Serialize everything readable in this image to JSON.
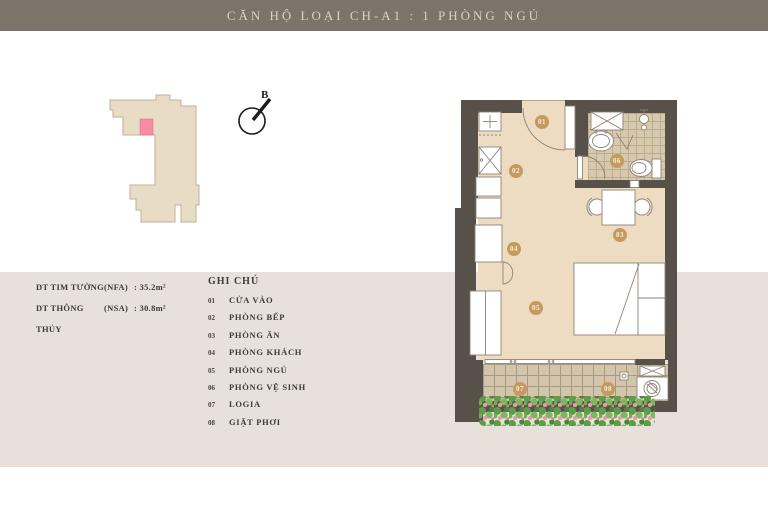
{
  "header": {
    "title": "CĂN HỘ LOẠI CH-A1 : 1 PHÒNG NGỦ"
  },
  "compass": {
    "label": "B"
  },
  "areas": {
    "rows": [
      {
        "label": "DT TIM TƯỜNG",
        "code": "(NFA)",
        "value": ": 35.2m²"
      },
      {
        "label": "DT THÔNG THỦY",
        "code": "(NSA)",
        "value": ": 30.8m²"
      }
    ]
  },
  "legend": {
    "heading": "GHI CHÚ",
    "items": [
      {
        "num": "01",
        "label": "CỬA VÀO"
      },
      {
        "num": "02",
        "label": "PHÒNG BẾP"
      },
      {
        "num": "03",
        "label": "PHÒNG ĂN"
      },
      {
        "num": "04",
        "label": "PHÒNG KHÁCH"
      },
      {
        "num": "05",
        "label": "PHÒNG NGỦ"
      },
      {
        "num": "06",
        "label": "PHÒNG VỆ SINH"
      },
      {
        "num": "07",
        "label": "LOGIA"
      },
      {
        "num": "08",
        "label": "GIẶT PHƠI"
      }
    ]
  },
  "colors": {
    "header-bg": "#7c7369",
    "header-text": "#d9d2c6",
    "band": "#e8e1db",
    "wall": "#57514a",
    "floor": "#eddcc2",
    "tile": "#d7c9ae",
    "loggia-tile": "#d3c5ac",
    "marker": "#c59a5f",
    "text": "#3e3a35",
    "keyplan-fill": "#e9dcc7",
    "keyplan-stroke": "#c2b198",
    "unit-pink": "#f78da0"
  }
}
